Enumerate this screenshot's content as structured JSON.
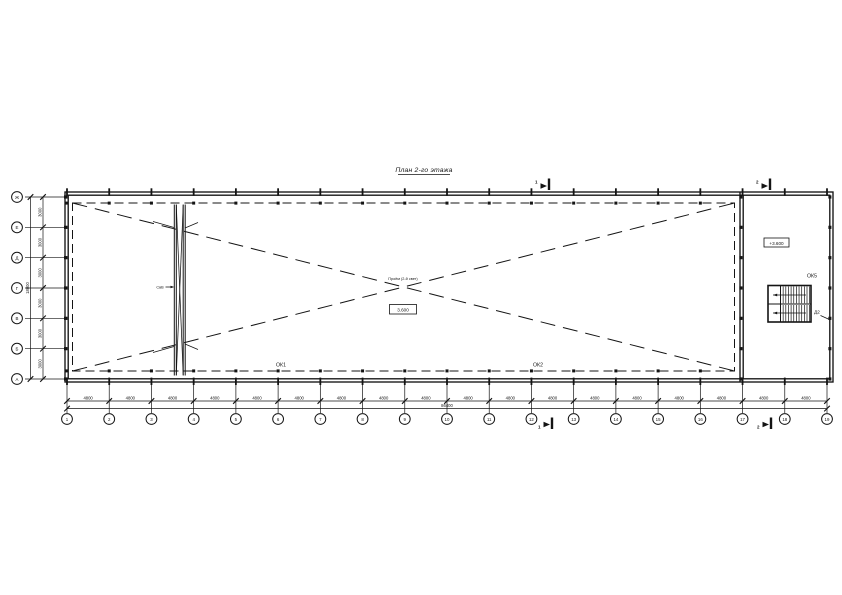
{
  "title": "План 2-го этажа",
  "axes": {
    "bottom": {
      "labels": [
        "1",
        "2",
        "3",
        "4",
        "5",
        "6",
        "7",
        "8",
        "9",
        "10",
        "11",
        "12",
        "13",
        "14",
        "15",
        "16",
        "17",
        "18",
        "19"
      ],
      "bay_dims": [
        "4800",
        "4800",
        "4800",
        "4800",
        "4800",
        "4800",
        "4800",
        "4800",
        "4800",
        "4800",
        "4800",
        "4800",
        "4800",
        "4800",
        "4800",
        "4800",
        "4800",
        "4800"
      ],
      "total_dim": "86400"
    },
    "left": {
      "labels": [
        "Ж",
        "Е",
        "Д",
        "Г",
        "В",
        "Б",
        "А"
      ],
      "bay_dims": [
        "3000",
        "3000",
        "3000",
        "3000",
        "3000",
        "3000"
      ],
      "total_dim": "18000"
    }
  },
  "annotations": {
    "window_label_1": "ОК1",
    "window_label_2": "ОК2",
    "window_label_5": "ОК5",
    "door_label": "Д2",
    "brace_label": "СвВ",
    "center_note": "Проём (2-й свет)",
    "hall_level": "3.600",
    "stair_level": "+3.600",
    "section_left": "1",
    "section_right": "2"
  },
  "colors": {
    "ink": "#141414",
    "paper": "#ffffff"
  }
}
